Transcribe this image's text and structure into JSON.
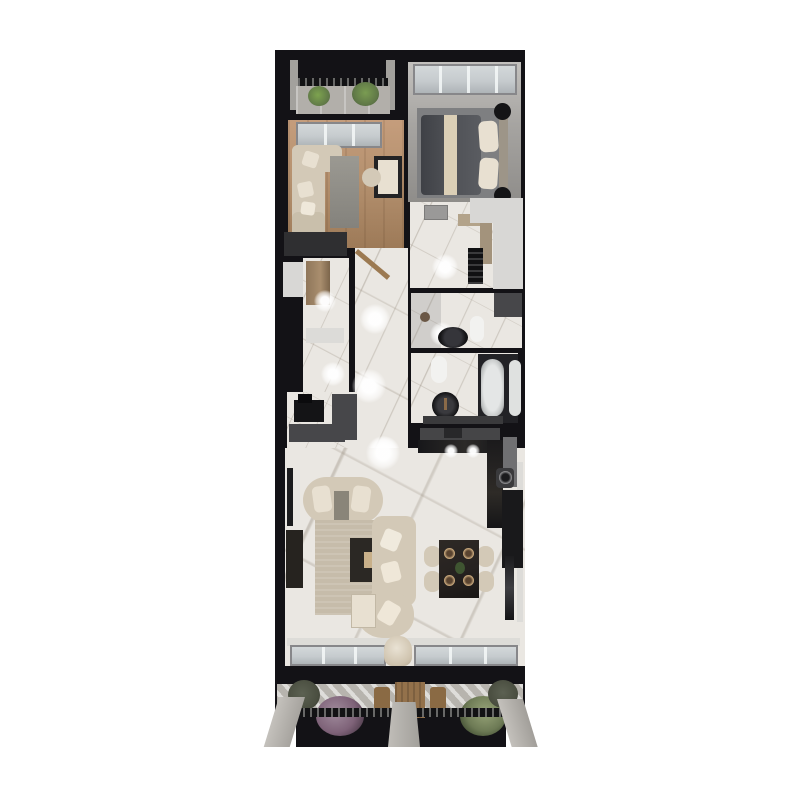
{
  "scene": {
    "description": "Top-down 3D architectural render of a narrow apartment floor plan with north balcony, two bedrooms, entry closet, hallway, utility room, two bathrooms, open kitchen / living / dining area and a large south terrace",
    "background": "#ffffff"
  },
  "palette": {
    "wall": "#131216",
    "marble": "#eae7e2",
    "woodFloor": "#b5916f",
    "bedroomFloor": "#a6a4a1",
    "carpet": "#7e7f81",
    "concrete": "#b2afaa",
    "deck": "#b7b4ae",
    "beige": "#d3c9b7",
    "beigeLight": "#e8e0d1",
    "duvet": "#4d4f54",
    "blanket": "#dbcfb6",
    "blackFurniture": "#141416",
    "darkGray": "#47474a",
    "midGray": "#6e6e70",
    "adjacent": "#d8d7d5",
    "glass": "#c6cbce",
    "glassFrame": "#87878a",
    "plantGreen": "#5f7747",
    "plantPurple": "#7e6278",
    "plantDark": "#4a4e40",
    "doorWood": "#9c7a52",
    "tableWood": "#93714b",
    "darkMarble": "#262220"
  },
  "rooms": [
    {
      "name": "north balcony",
      "items": [
        "planter",
        "planter",
        "railing",
        "concrete floor"
      ]
    },
    {
      "name": "primary bedroom",
      "items": [
        "window wall",
        "area rug",
        "double bed with dark duvet and beige blanket",
        "pillows",
        "headboard bench",
        "round nightstand",
        "round nightstand"
      ]
    },
    {
      "name": "second bedroom",
      "items": [
        "window wall",
        "daybed sofa with pillows",
        "runner rug",
        "desk with chair",
        "low wardrobe"
      ]
    },
    {
      "name": "entry closet",
      "items": [
        "wardrobe cabinet",
        "mat",
        "ceiling spotlight"
      ]
    },
    {
      "name": "hallway",
      "items": [
        "open entry door",
        "ceiling spotlights",
        "marble floor"
      ]
    },
    {
      "name": "utility room",
      "items": [
        "ceiling vent",
        "counter",
        "shelving tower",
        "ceiling spotlight"
      ]
    },
    {
      "name": "shower bathroom",
      "items": [
        "walk-in shower",
        "black vessel sink",
        "toilet",
        "partition"
      ]
    },
    {
      "name": "tub bathroom",
      "items": [
        "toilet",
        "black vessel sink",
        "freestanding bathtub",
        "shower tray",
        "vanity ledge"
      ]
    },
    {
      "name": "kitchen",
      "items": [
        "dark stone L-counter",
        "hood",
        "round sink",
        "tall appliance column"
      ]
    },
    {
      "name": "living dining room",
      "items": [
        "curved loveseat",
        "sectional sofa with chaise",
        "area rug",
        "dark coffee table",
        "side chest",
        "TV console",
        "wall art",
        "dining table with four place settings",
        "four dining chairs",
        "mirror panel",
        "south window wall with curtain"
      ]
    },
    {
      "name": "south terrace",
      "items": [
        "outdoor wooden dining set",
        "planter",
        "flowering bush",
        "green bush",
        "planter",
        "railing",
        "concrete piers"
      ]
    }
  ]
}
